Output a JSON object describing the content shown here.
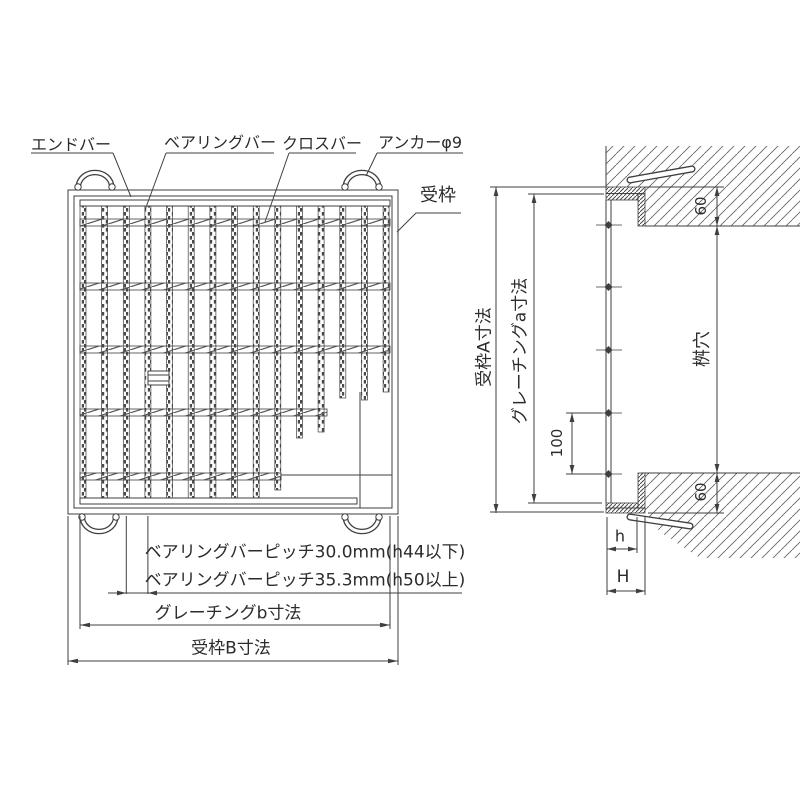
{
  "drawing": {
    "type": "steel-grating installation drawing",
    "views": [
      "plan",
      "side-section"
    ]
  },
  "plan": {
    "labels": {
      "end_bar": "エンドバー",
      "bearing_bar": "ベアリングバー",
      "cross_bar": "クロスバー",
      "anchor": "アンカーφ9",
      "frame": "受枠"
    },
    "notes": {
      "pitch_1": "ベアリングバーピッチ30.0mm(h44以下)",
      "pitch_2": "ベアリングバーピッチ35.3mm(h50以上)"
    },
    "dims": {
      "grating_b": "グレーチングb寸法",
      "frame_b": "受枠B寸法"
    },
    "structure": {
      "bearing_bar_count": 15,
      "cross_bar_rows": 5,
      "lifting_anchor_count": 4
    }
  },
  "side": {
    "dims": {
      "frame_a": "受枠A寸法",
      "grating_a": "グレーチングa寸法",
      "anchor_pitch": "100",
      "pit": "桝穴",
      "embed_top": "60",
      "embed_bottom": "60",
      "grating_height": "h",
      "frame_height": "H"
    },
    "structure": {
      "anchor_point_count": 5
    }
  },
  "colors": {
    "line": "#3f3f3f",
    "text": "#2b2b2b",
    "background": "#ffffff"
  }
}
